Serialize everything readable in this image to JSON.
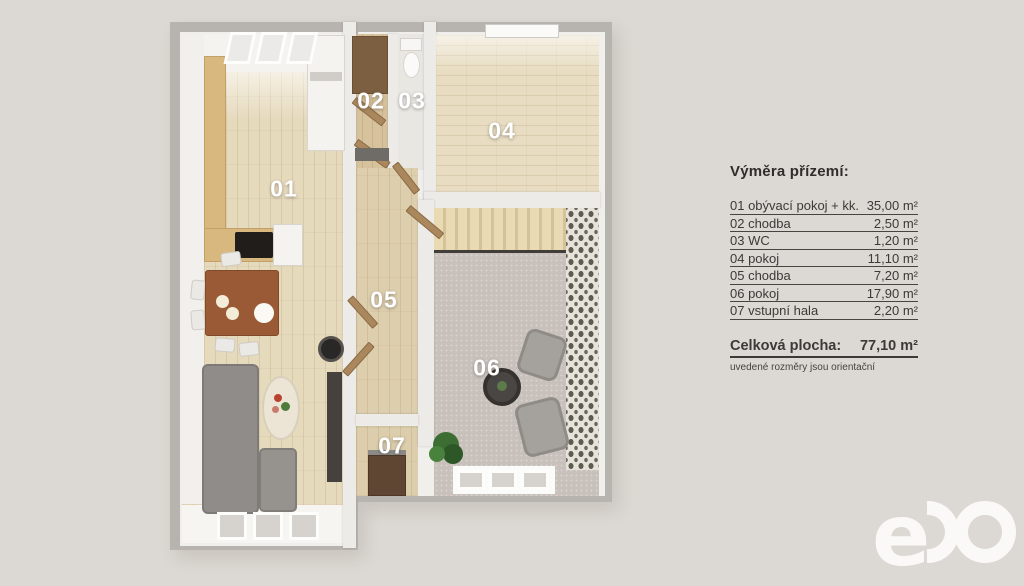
{
  "background_color": "#dcd8d3",
  "floorplan": {
    "room_labels": {
      "r01": "01",
      "r02": "02",
      "r03": "03",
      "r04": "04",
      "r05": "05",
      "r06": "06",
      "r07": "07"
    }
  },
  "legend": {
    "title": "Výměra přízemí:",
    "rows": [
      {
        "label": "01 obývací pokoj + kk.",
        "value": "35,00 m²"
      },
      {
        "label": "02 chodba",
        "value": "2,50 m²"
      },
      {
        "label": "03 WC",
        "value": "1,20 m²"
      },
      {
        "label": "04 pokoj",
        "value": "11,10 m²"
      },
      {
        "label": "05 chodba",
        "value": "7,20 m²"
      },
      {
        "label": "06 pokoj",
        "value": "17,90 m²"
      },
      {
        "label": "07 vstupní hala",
        "value": "2,20 m²"
      }
    ],
    "total": {
      "label": "Celková plocha:",
      "value": "77,10 m²"
    },
    "disclaimer": "uvedené rozměry jsou orientační"
  },
  "logo": {
    "letter_e": "e"
  }
}
